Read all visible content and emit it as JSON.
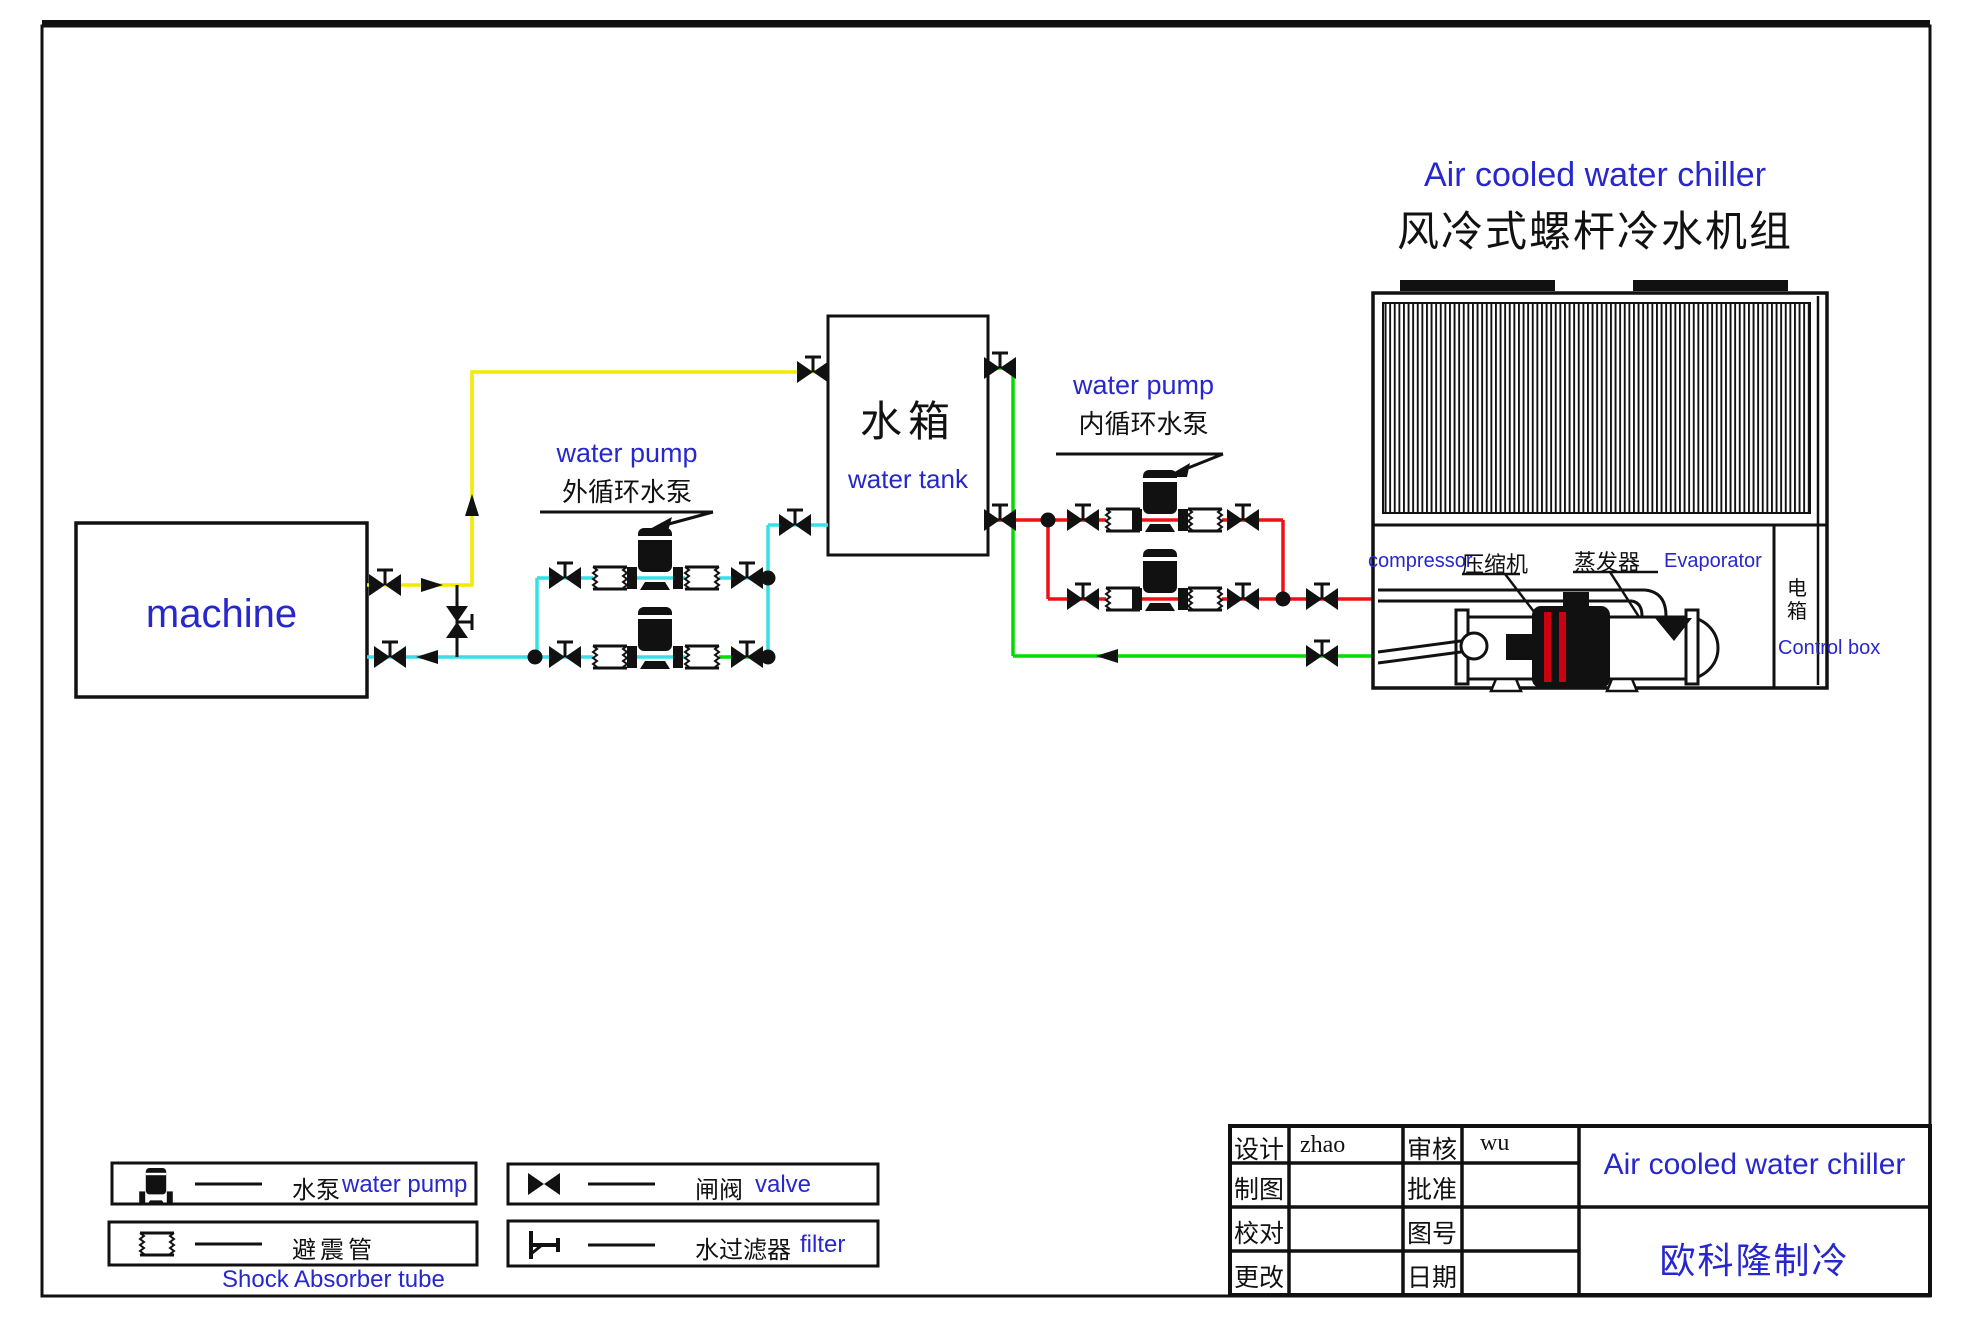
{
  "drawing_title": {
    "en": "Air cooled water chiller",
    "zh": "风冷式螺杆冷水机组"
  },
  "machine": {
    "label": "machine"
  },
  "water_tank": {
    "zh": "水箱",
    "en": "water tank"
  },
  "external_pump_label": {
    "en": "water pump",
    "zh": "外循环水泵"
  },
  "internal_pump_label": {
    "en": "water pump",
    "zh": "内循环水泵"
  },
  "chiller": {
    "compressor_en": "compressor",
    "compressor_zh": "压缩机",
    "evaporator_zh": "蒸发器",
    "evaporator_en": "Evaporator",
    "control_box_zh": "电箱",
    "control_box_en": "Control box"
  },
  "legend": {
    "water_pump_zh": "水泵",
    "water_pump_en": "water pump",
    "shock_absorber_zh": "避震管",
    "shock_absorber_en": "Shock Absorber tube",
    "valve_zh": "闸阀",
    "valve_en": "valve",
    "filter_zh": "水过滤器",
    "filter_en": "filter",
    "icons": {
      "water_pump": "pump-cylinder-icon",
      "shock_absorber": "wavy-rect-icon",
      "valve": "bowtie-valve-icon",
      "filter": "strainer-icon"
    }
  },
  "title_block": {
    "rows": [
      {
        "label1": "设计",
        "value1": "zhao",
        "label2": "审核",
        "value2": "wu"
      },
      {
        "label1": "制图",
        "value1": "",
        "label2": "批准",
        "value2": ""
      },
      {
        "label1": "校对",
        "value1": "",
        "label2": "图号",
        "value2": ""
      },
      {
        "label1": "更改",
        "value1": "",
        "label2": "日期",
        "value2": ""
      }
    ],
    "product": "Air cooled water chiller",
    "company": "欧科隆制冷"
  },
  "colors": {
    "hot_water_pipe": "#f2ea00",
    "cool_water_pipe": "#35e0e6",
    "chilled_supply_pipe": "#ee1012",
    "chilled_return_pipe": "#00dc00",
    "label_blue": "#2727cd",
    "line_black": "#111111"
  }
}
